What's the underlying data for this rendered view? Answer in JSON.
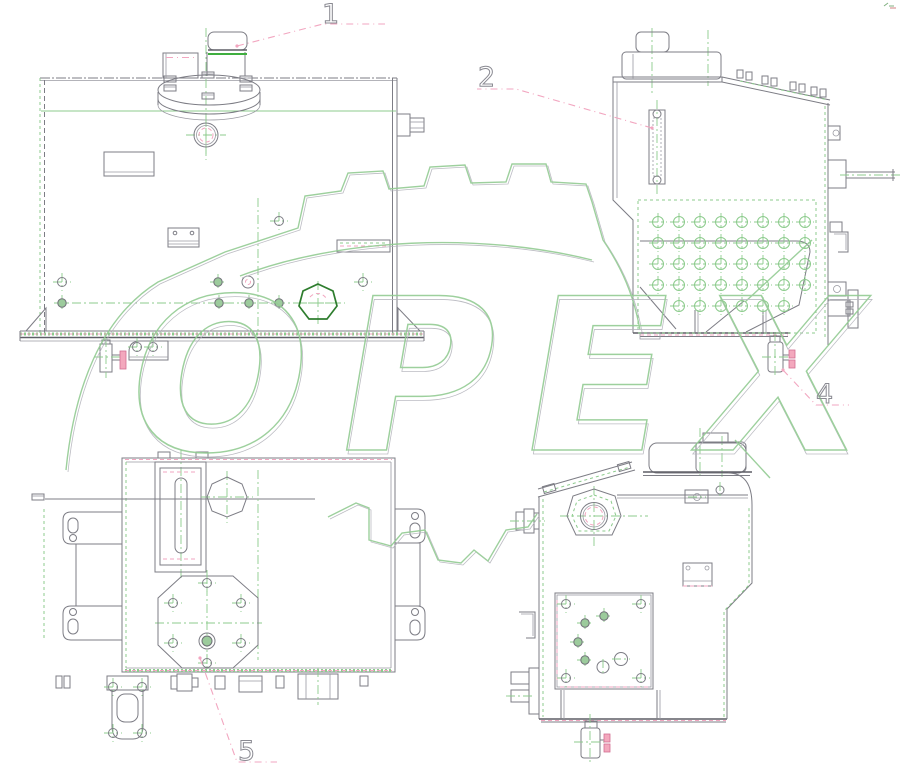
{
  "watermark": {
    "text": "OPEX",
    "text_color": "#93cb93",
    "shadow_color": "#b4b4bc"
  },
  "callouts": [
    {
      "label": "1",
      "target": "breather-filler-cap"
    },
    {
      "label": "2",
      "target": "oil-level-sight-gauge"
    },
    {
      "label": "4",
      "target": "drain-valve"
    },
    {
      "label": "5",
      "target": "cleanout-cover-flange"
    }
  ],
  "palette": {
    "background": "#ffffff",
    "line": "#7d7d85",
    "line_dark": "#5e5e66",
    "green": "#8ccb8c",
    "green_bright": "#3fae3f",
    "green_dark": "#2e7d2e",
    "pink": "#f2a6c0",
    "pink_fill": "#f3a8bd",
    "digit": "#8a8a92"
  }
}
